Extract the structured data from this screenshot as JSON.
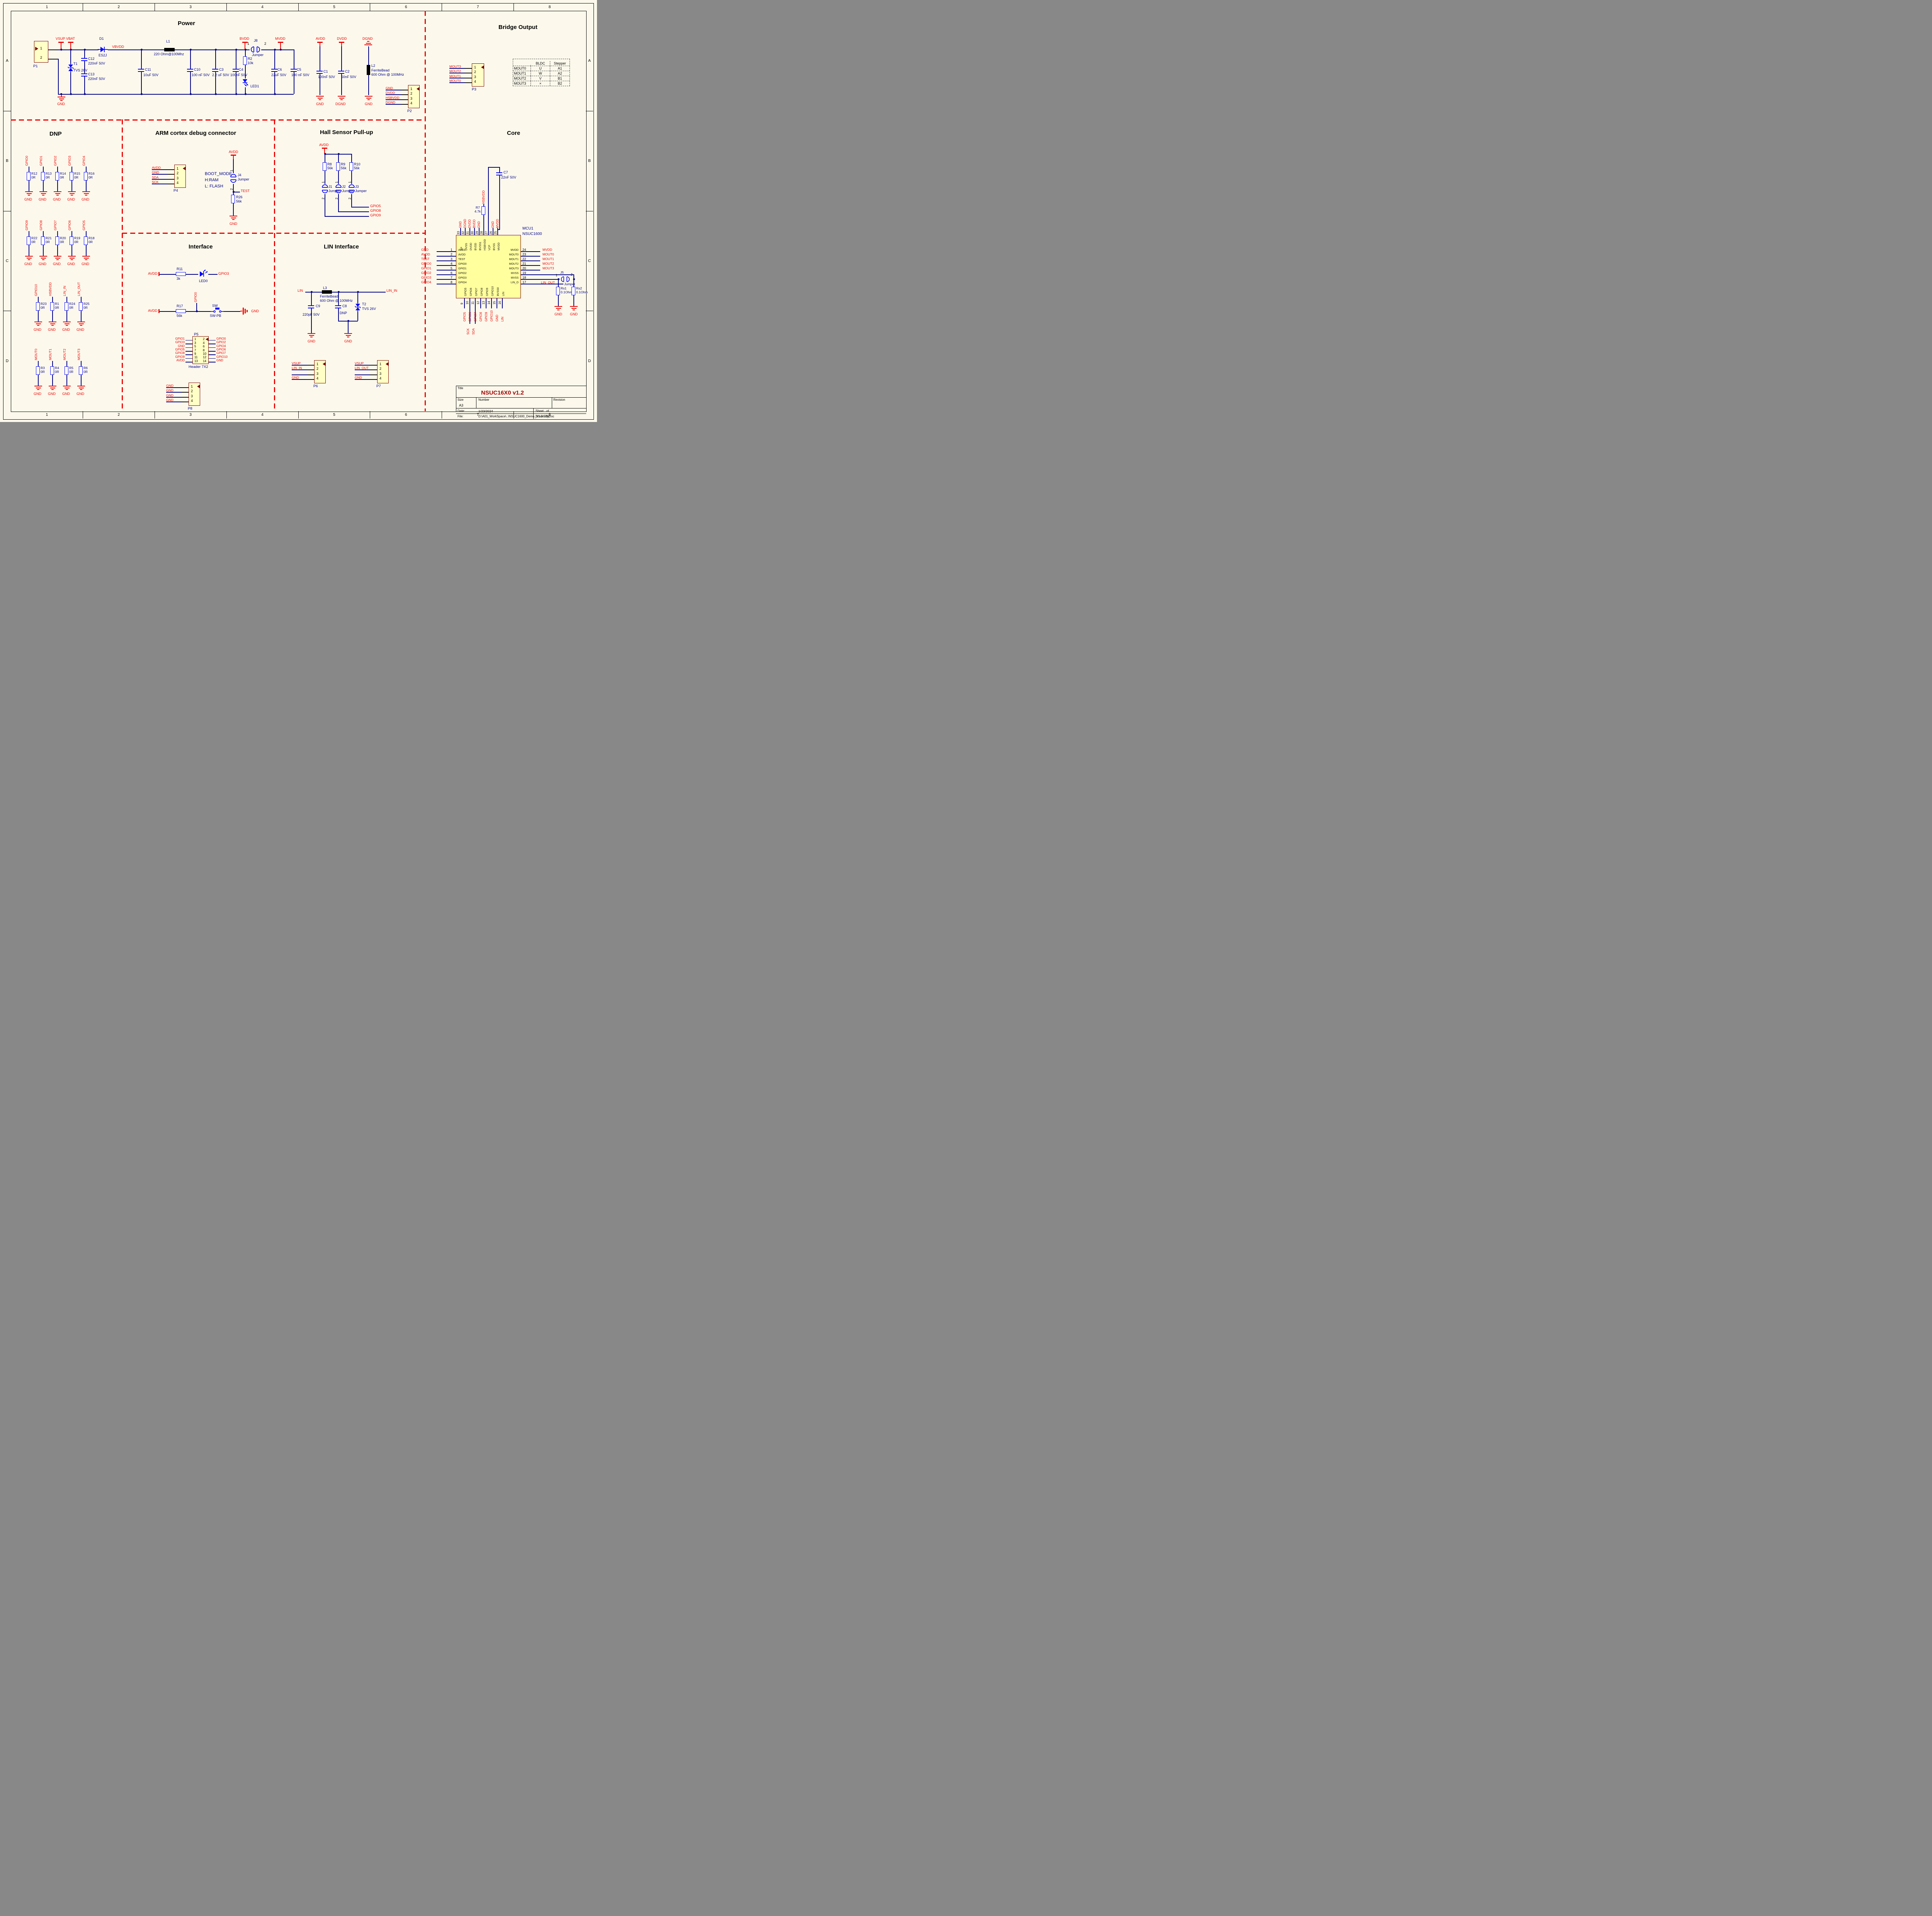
{
  "sheet": {
    "columns": [
      "1",
      "2",
      "3",
      "4",
      "5",
      "6",
      "7",
      "8"
    ],
    "rows": [
      "A",
      "B",
      "C",
      "D"
    ]
  },
  "titles": {
    "power": "Power",
    "bridge": "Bridge Output",
    "dnp": "DNP",
    "arm": "ARM cortex debug connector",
    "hall": "Hall Sensor Pull-up",
    "core": "Core",
    "iface": "Interface",
    "lin": "LIN Interface"
  },
  "common": {
    "gnd": "GND",
    "dgnd": "DGND",
    "avdd": "AVDD",
    "vsup": "VSUP",
    "jumper": "Jumper",
    "p1": "1",
    "p2": "2",
    "zr": "0R",
    "v56k": "56k"
  },
  "power": {
    "p1": {
      "ref": "P1",
      "pins": [
        {
          "num": "1"
        },
        {
          "num": "2"
        }
      ]
    },
    "vbat": "VBAT",
    "vbvdd": "VBVDD",
    "bvdd": "BVDD",
    "mvdd": "MVDD",
    "dvdd": "DVDD",
    "dgnd_top": "DGND",
    "d1": {
      "ref": "D1",
      "value": "ES2J"
    },
    "t1": {
      "ref": "T1",
      "value": "TVS 26V"
    },
    "c12": {
      "ref": "C12",
      "value": "220nF 50V"
    },
    "c13": {
      "ref": "C13",
      "value": "220nF 50V"
    },
    "l1": {
      "ref": "L1",
      "value": "220 Ohm@100Mhz"
    },
    "c11": {
      "ref": "C11",
      "value": "10uF 50V"
    },
    "c10": {
      "ref": "C10",
      "value": "100 nF 50V"
    },
    "c3": {
      "ref": "C3",
      "value": "2.2 uF 50V"
    },
    "c4": {
      "ref": "C4",
      "value": "100nF 50V"
    },
    "r2": {
      "ref": "R2",
      "value": "10k"
    },
    "j8": {
      "ref": "J8"
    },
    "led1": {
      "ref": "LED1"
    },
    "c6": {
      "ref": "C6",
      "value": "22uF 50V"
    },
    "c5": {
      "ref": "C5",
      "value": "100 nF 50V"
    },
    "c1": {
      "ref": "C1",
      "value": "100nF 50V"
    },
    "c2": {
      "ref": "C2",
      "value": "50nF 50V"
    },
    "l2": {
      "ref": "L2",
      "value": "FerriteBead",
      "value2": "600 Ohm @ 100MHz"
    },
    "p2": {
      "ref": "P2",
      "pins": [
        {
          "num": "1",
          "net": "GND"
        },
        {
          "num": "2",
          "net": "DVDD"
        },
        {
          "num": "3",
          "net": "HSBVDD"
        },
        {
          "num": "4",
          "net": "DGND"
        }
      ]
    }
  },
  "bridge": {
    "p3": {
      "ref": "P3",
      "pins": [
        {
          "num": "1",
          "net": "MOUT3"
        },
        {
          "num": "2",
          "net": "MOUT2"
        },
        {
          "num": "3",
          "net": "MOUT1"
        },
        {
          "num": "4",
          "net": "MOUT0"
        }
      ]
    },
    "table": {
      "col1": "BLDC",
      "col2": "Stepper",
      "rows": [
        [
          "MOUT0",
          "U",
          "A1"
        ],
        [
          "MOUT1",
          "W",
          "A2"
        ],
        [
          "MOUT2",
          "V",
          "B1"
        ],
        [
          "MOUT3",
          "×",
          "B2"
        ]
      ]
    }
  },
  "dnp": {
    "row1": [
      {
        "net": "GPIO0",
        "ref": "R12"
      },
      {
        "net": "GPIO1",
        "ref": "R13"
      },
      {
        "net": "GPIO2",
        "ref": "R14"
      },
      {
        "net": "GPIO3",
        "ref": "R15"
      },
      {
        "net": "GPIO4",
        "ref": "R16"
      }
    ],
    "row2": [
      {
        "net": "GPIO9",
        "ref": "R22"
      },
      {
        "net": "GPIO8",
        "ref": "R21"
      },
      {
        "net": "GPIO7",
        "ref": "R20"
      },
      {
        "net": "GPIO6",
        "ref": "R19"
      },
      {
        "net": "GPIO5",
        "ref": "R18"
      }
    ],
    "row3": [
      {
        "net": "GPIO10",
        "ref": "R23"
      },
      {
        "net": "HSBVDD",
        "ref": "R1"
      },
      {
        "net": "LIN_IN",
        "ref": "R24"
      },
      {
        "net": "LIN_OUT",
        "ref": "R25"
      }
    ],
    "row4": [
      {
        "net": "MOUT0",
        "ref": "R3"
      },
      {
        "net": "MOUT1",
        "ref": "R4"
      },
      {
        "net": "MOUT2",
        "ref": "R5"
      },
      {
        "net": "MOUT3",
        "ref": "R6"
      }
    ]
  },
  "arm": {
    "p4": {
      "ref": "P4",
      "pins": [
        {
          "num": "1",
          "net": "AVDD"
        },
        {
          "num": "2",
          "net": "GND"
        },
        {
          "num": "3",
          "net": "SDA"
        },
        {
          "num": "4",
          "net": "SCK"
        }
      ]
    },
    "boot1": "BOOT_MODE",
    "boot2": "H:RAM",
    "boot3": "L: FLASH",
    "j4": {
      "ref": "J4"
    },
    "test": "TEST",
    "r26": {
      "ref": "R26"
    }
  },
  "hall": {
    "res": [
      {
        "ref": "R8"
      },
      {
        "ref": "R9"
      },
      {
        "ref": "R10"
      }
    ],
    "jumpers": [
      {
        "ref": "J1"
      },
      {
        "ref": "J2"
      },
      {
        "ref": "J3"
      }
    ],
    "outs": [
      "GPIO5",
      "GPIO8",
      "GPIO9"
    ]
  },
  "iface": {
    "r11": {
      "ref": "R11",
      "value": "3k"
    },
    "led0": {
      "ref": "LED0"
    },
    "gpio3": "GPIO3",
    "gpio0": "GPIO0",
    "r17": {
      "ref": "R17"
    },
    "sw": {
      "ref": "SW",
      "value": "SW-PB"
    },
    "p5": {
      "ref": "P5",
      "footer": "Header 7X2",
      "rows": [
        {
          "ln": "1",
          "lnet": "GPIO1",
          "rn": "2",
          "rnet": "GPIO0"
        },
        {
          "ln": "3",
          "lnet": "GPIO3",
          "rn": "4",
          "rnet": "GPIO2"
        },
        {
          "ln": "5",
          "lnet": "GND",
          "rn": "6",
          "rnet": "GPIO4"
        },
        {
          "ln": "7",
          "lnet": "GPIO5",
          "rn": "8",
          "rnet": "GPIO6"
        },
        {
          "ln": "9",
          "lnet": "GPIO8",
          "rn": "10",
          "rnet": "GPIO7"
        },
        {
          "ln": "11",
          "lnet": "GPIO9",
          "rn": "12",
          "rnet": "GPIO10"
        },
        {
          "ln": "13",
          "lnet": "AVDD",
          "rn": "14",
          "rnet": "GND"
        }
      ]
    },
    "p8": {
      "ref": "P8",
      "pins": [
        {
          "num": "1",
          "net": "GND"
        },
        {
          "num": "2",
          "net": "GND"
        },
        {
          "num": "3",
          "net": "GND"
        },
        {
          "num": "4",
          "net": "GND"
        }
      ]
    }
  },
  "lin": {
    "lin": "LIN",
    "lin_in": "LIN_IN",
    "l3": {
      "ref": "L3",
      "value": "FerriteBead",
      "value2": "600 Ohm @ 100MHz"
    },
    "c9": {
      "ref": "C9",
      "value": "220pF 50V"
    },
    "c8": {
      "ref": "C8",
      "value": "DNP"
    },
    "t2": {
      "ref": "T2",
      "value": "TVS 26V"
    },
    "p6": {
      "ref": "P6",
      "pins": [
        {
          "num": "1",
          "net": "VSUP"
        },
        {
          "num": "2",
          "net": "LIN_IN"
        },
        {
          "num": "3",
          "net": ""
        },
        {
          "num": "4",
          "net": "GND"
        }
      ]
    },
    "p7": {
      "ref": "P7",
      "pins": [
        {
          "num": "1",
          "net": "VSUP"
        },
        {
          "num": "2",
          "net": "LIN_OUT"
        },
        {
          "num": "3",
          "net": ""
        },
        {
          "num": "4",
          "net": "GND"
        }
      ]
    }
  },
  "core": {
    "c7": {
      "ref": "C7",
      "value": "22nF 50V"
    },
    "hsbvdd": "HSBVDD",
    "r7": {
      "ref": "R7",
      "value": "4.7k"
    },
    "sck": "SCK",
    "sda": "SDA",
    "lin_out": "LIN_OUT",
    "j5": {
      "ref": "J5"
    },
    "rs1": {
      "ref": "Rs1",
      "value": "0.1Ohm"
    },
    "rs2": {
      "ref": "Rs2",
      "value": "0.1Ohm"
    },
    "mcu": {
      "ref": "MCU1",
      "part": "NSUC1600",
      "left": [
        {
          "num": "1",
          "name": "AVSS",
          "net": "GND"
        },
        {
          "num": "2",
          "name": "AVDD",
          "net": "AVDD"
        },
        {
          "num": "3",
          "name": "TEST",
          "net": "TEST"
        },
        {
          "num": "4",
          "name": "GPIO0",
          "net": "GPIO0"
        },
        {
          "num": "5",
          "name": "GPIO1",
          "net": "GPIO1"
        },
        {
          "num": "6",
          "name": "GPIO2",
          "net": "GPIO2"
        },
        {
          "num": "7",
          "name": "GPIO3",
          "net": "GPIO3"
        },
        {
          "num": "8",
          "name": "GPIO4",
          "net": "GPIO4"
        }
      ],
      "right": [
        {
          "num": "24",
          "name": "MVDD",
          "net": "MVDD"
        },
        {
          "num": "23",
          "name": "MOUT0",
          "net": "MOUT0"
        },
        {
          "num": "22",
          "name": "MOUT1",
          "net": "MOUT1"
        },
        {
          "num": "21",
          "name": "MOUT2",
          "net": "MOUT2"
        },
        {
          "num": "20",
          "name": "MOUT3",
          "net": "MOUT3"
        },
        {
          "num": "19",
          "name": "MVSS",
          "net": ""
        },
        {
          "num": "18",
          "name": "MVSS",
          "net": ""
        },
        {
          "num": "17",
          "name": "LIN_O",
          "net": ""
        }
      ],
      "top": [
        {
          "num": "33",
          "name": "EP",
          "net": "GND"
        },
        {
          "num": "32",
          "name": "DVSS",
          "net": "DGND"
        },
        {
          "num": "31",
          "name": "DVDD",
          "net": "DVDD"
        },
        {
          "num": "30",
          "name": "BVDD",
          "net": "BVDD"
        },
        {
          "num": "29",
          "name": "BVSS1",
          "net": "GND"
        },
        {
          "num": "28",
          "name": "HSBVDD",
          "net": ""
        },
        {
          "num": "27",
          "name": "VCP",
          "net": ""
        },
        {
          "num": "26",
          "name": "BVSS",
          "net": "GND"
        },
        {
          "num": "25",
          "name": "MVDD",
          "net": "MVDD"
        }
      ],
      "bottom": [
        {
          "num": "9",
          "name": "GPIO5",
          "net": "GPIO5"
        },
        {
          "num": "10",
          "name": "GPIO6",
          "net": "GPIO6"
        },
        {
          "num": "11",
          "name": "GPIO7",
          "net": "GPIO7"
        },
        {
          "num": "12",
          "name": "GPIO8",
          "net": "GPIO8"
        },
        {
          "num": "13",
          "name": "GPIO9",
          "net": "GPIO9"
        },
        {
          "num": "14",
          "name": "GPIO10",
          "net": "GPIO10"
        },
        {
          "num": "15",
          "name": "BVSS0",
          "net": "GND"
        },
        {
          "num": "16",
          "name": "LIN",
          "net": "LIN"
        }
      ]
    }
  },
  "tb": {
    "title_label": "Title",
    "title": "NSUC16X0 v1.2",
    "size_label": "Size",
    "size": "A3",
    "number_label": "Number",
    "revision_label": "Revision",
    "date_label": "Date:",
    "date": "1/23/2024",
    "sheet_label": "Sheet",
    "sheet_of": "of",
    "file_label": "File:",
    "file": "D:\\A01_WorkSpace\\..\\NSUC1600_Demo_V1.3.SchDoc",
    "drawn": "Drawn By:"
  }
}
